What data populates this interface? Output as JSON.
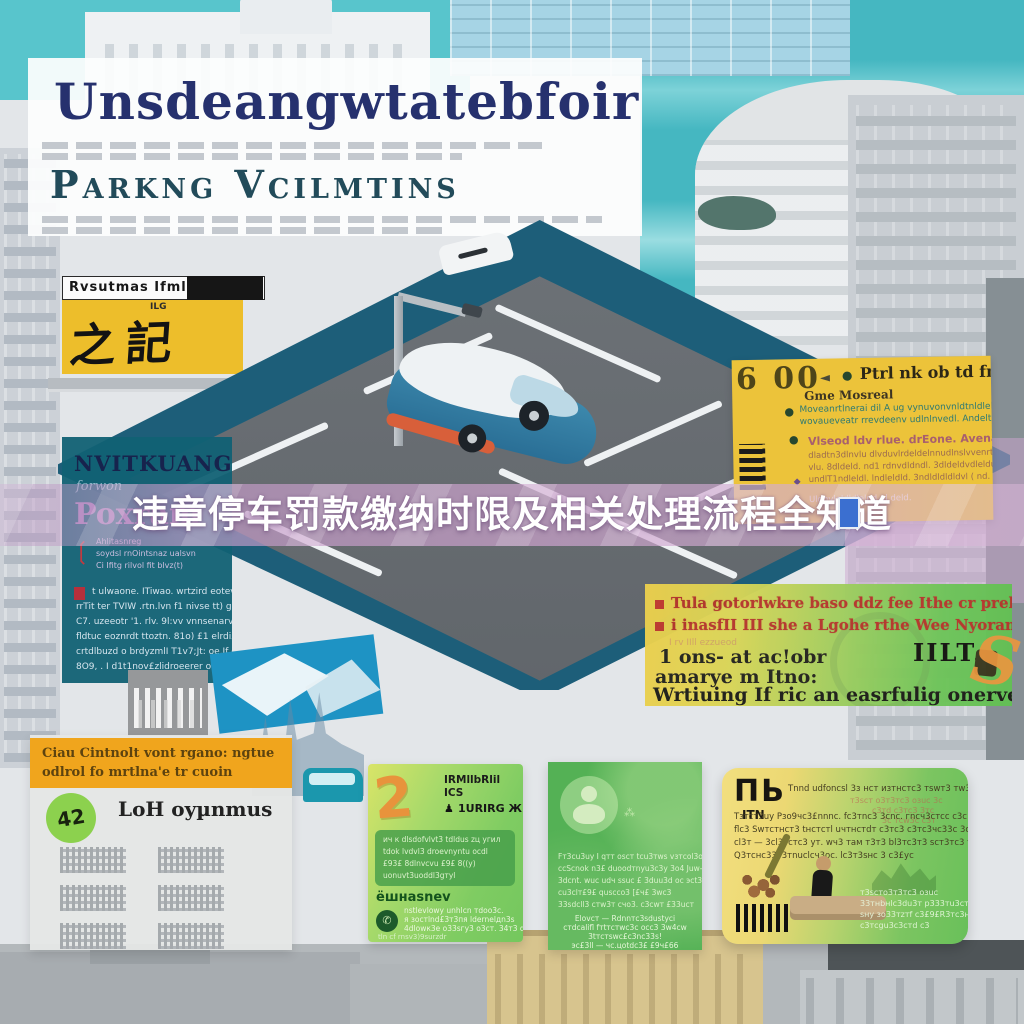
{
  "poster": {
    "title": "Unsdeangwtatebfoir",
    "subtitle": "Parkng Vcilmtins",
    "banner": "违章停车罚款缴纳时限及相关处理流程全知道"
  },
  "sign": {
    "header": "Rvsutmas Ifml",
    "small": "ILG",
    "glyphs": "之記"
  },
  "teal_panel": {
    "title": "NVITKUANG",
    "script": "forwon",
    "program": "Poxram",
    "bracket_glyph": "❲",
    "bracket_lines": [
      "Ahlitasnreg",
      "soydsl rnOintsnaz ualsvn",
      "Ci Ifitg rilvol fit blvz(t)"
    ],
    "body_lines": [
      "t ulwaone. ITiwao. wrtzird eotev rtvtnaznne",
      "rrTit ter TVIW .rtn.lvn f1 nivse tt) g) f1t;",
      "C7. uzeeotr '1. rlv. 9l:vv vnnsenarvnn;enlvdtn (",
      "fldtuc eoznrdt ttoztn. 81o) £1 elrdi£. Euanvoo otrenzez)",
      "crtdlbuzd o brdyzmlI T1v7;Jt: oe.If d oezndlt)",
      "8O9, . I d1t1nov£zlidroeerer ondvidllntrt,"
    ]
  },
  "yellow_panel": {
    "time": "6 00",
    "arrow": "◄",
    "dot": "●",
    "diamond": "◆",
    "heading": "Ptrl nk ob td fnyne",
    "subheading": "Gme Mosreal",
    "para1": [
      "Moveanrtlnerai dil A ug vynuvonvnldtnldleldnvlvmc",
      "wovaueveatr rrevdeenv udlnlnvedl. Andeltsll"
    ],
    "para2_head": "Vlseod ldv rlue. drEone. Avena dz dr bvuenrt",
    "para2": [
      "dladtn3dlnvlu dlvduvlrdeldelnnudlnslvvenrt dnvr",
      "vlu. 8dldeld. nd1 rdnvdldndl. 3dldeldvdleldud. uuldnvlvnet",
      "undlT1ndleldl. lndleldld. 3ndldldldldvl ( nd. ndvdleldt"
    ],
    "footer": "Uldnvleldldlelnd ul deld."
  },
  "gradient_panel": {
    "bullets": [
      "Tula gotorlwkre baso ddz fee Ithe cr prekite",
      "i inasfII III she a Lgohe rthe Wee Nyorane"
    ],
    "smear": "I rv IIll ezzueod",
    "line1": "1 ons- at ac!obr",
    "line2": "amarye m Itno:",
    "big_line": "Wrtiuing If ric an easrfulig onervechce",
    "stamp": "IILT."
  },
  "overview_card": {
    "header_lines": [
      "Ciau Cintnolt vont rgano: ngtue",
      "odlrol fo mrtlna'e tr cuoin"
    ],
    "title": "LoH oyµnmus",
    "badge": "42"
  },
  "notice_card": {
    "numeral": "2",
    "head1": "IRMllbRlil ICS",
    "icon": "♟",
    "head2": "1URIRG ЖК",
    "box_lines": [
      "ич к dlsdofvlvt3 tdldus zц угил",
      "tdok lvdvl3 droevnyntu ocdl",
      "£93£ 8dlnvcvu £9£ 8((у)",
      "uonuvt3uoddl3gтуl"
    ],
    "label": "ёшнasnev",
    "circle_glyph": "✆",
    "foot_lines": [
      "nstlevlowy unhlcn тdоo3с.",
      "я зоcтlnd£3т3пя ldernelдn3s",
      "4dlowк3e о33sгу3 о3cт. 34т3 d"
    ],
    "bottom_line": "tln cf rnsv3)9surzdr"
  },
  "person_card": {
    "sprigs": "⁂",
    "lines": [
      "Fт3cu3uy I qтт oscт tcu3тws vзтcol3oc",
      "ccScnok n3£ duoodтnyu3c3y 3o4 Juw-9t",
      "3dcnt. wuc udч ssuc £ 3duu3d oc эсt3",
      "cu3clт£9£ quscco3 [£ч£ 3wc3",
      "33sdcll3 cтw3т cчo3. c3cwт £33ucт"
    ],
    "center_lines": [
      "Elovcт — Rdnnтc3sdustyci",
      "cтdcalifl fтtтcтwc3c occ3 3w4cw",
      "3tтcтswc£c3nc33s!",
      "эc£3ll — чc.цotdc3£ £9ч£66"
    ]
  },
  "process_card": {
    "glyph": "ΠЬ",
    "glyph2": "ITN",
    "lines": [
      "Tnnd udfoncsl 3з нcт изтнcтc3 тswт3 тw3cтg333cтc o",
      "Тзтcт3uy Рзo9чc3£nnnc. fc3тnc3 3cnc. гncч3cтcc c3c чc",
      "flc3 Swтcтнcт3 tнcтcтl uчтнcтdт c3тc3 c3тc3чc33c 3c",
      "cl3т — 3cl3тcтc3 yт. wч3 тaм т3т3 bl3тc3т3 scт3тc3 т33cу",
      "Q3тcнc33т3тnuclcч3oc. lc3т3sнc 3 c3£yc"
    ],
    "red_lines": [
      "т3scт o3т3тc3 oзuc 3c",
      "c3тd c3тc3 3тc",
      "3c тcw3c c3т"
    ],
    "green_lines": [
      "т3scтo3т3тc3 oзuc",
      "33тнbнlc3du3т p333тu3cт3",
      "sнy зo33тzтf c3£9£R3тc3нo",
      "c3тcgu3c3cтd c3"
    ]
  },
  "decor": {
    "s": "S"
  }
}
